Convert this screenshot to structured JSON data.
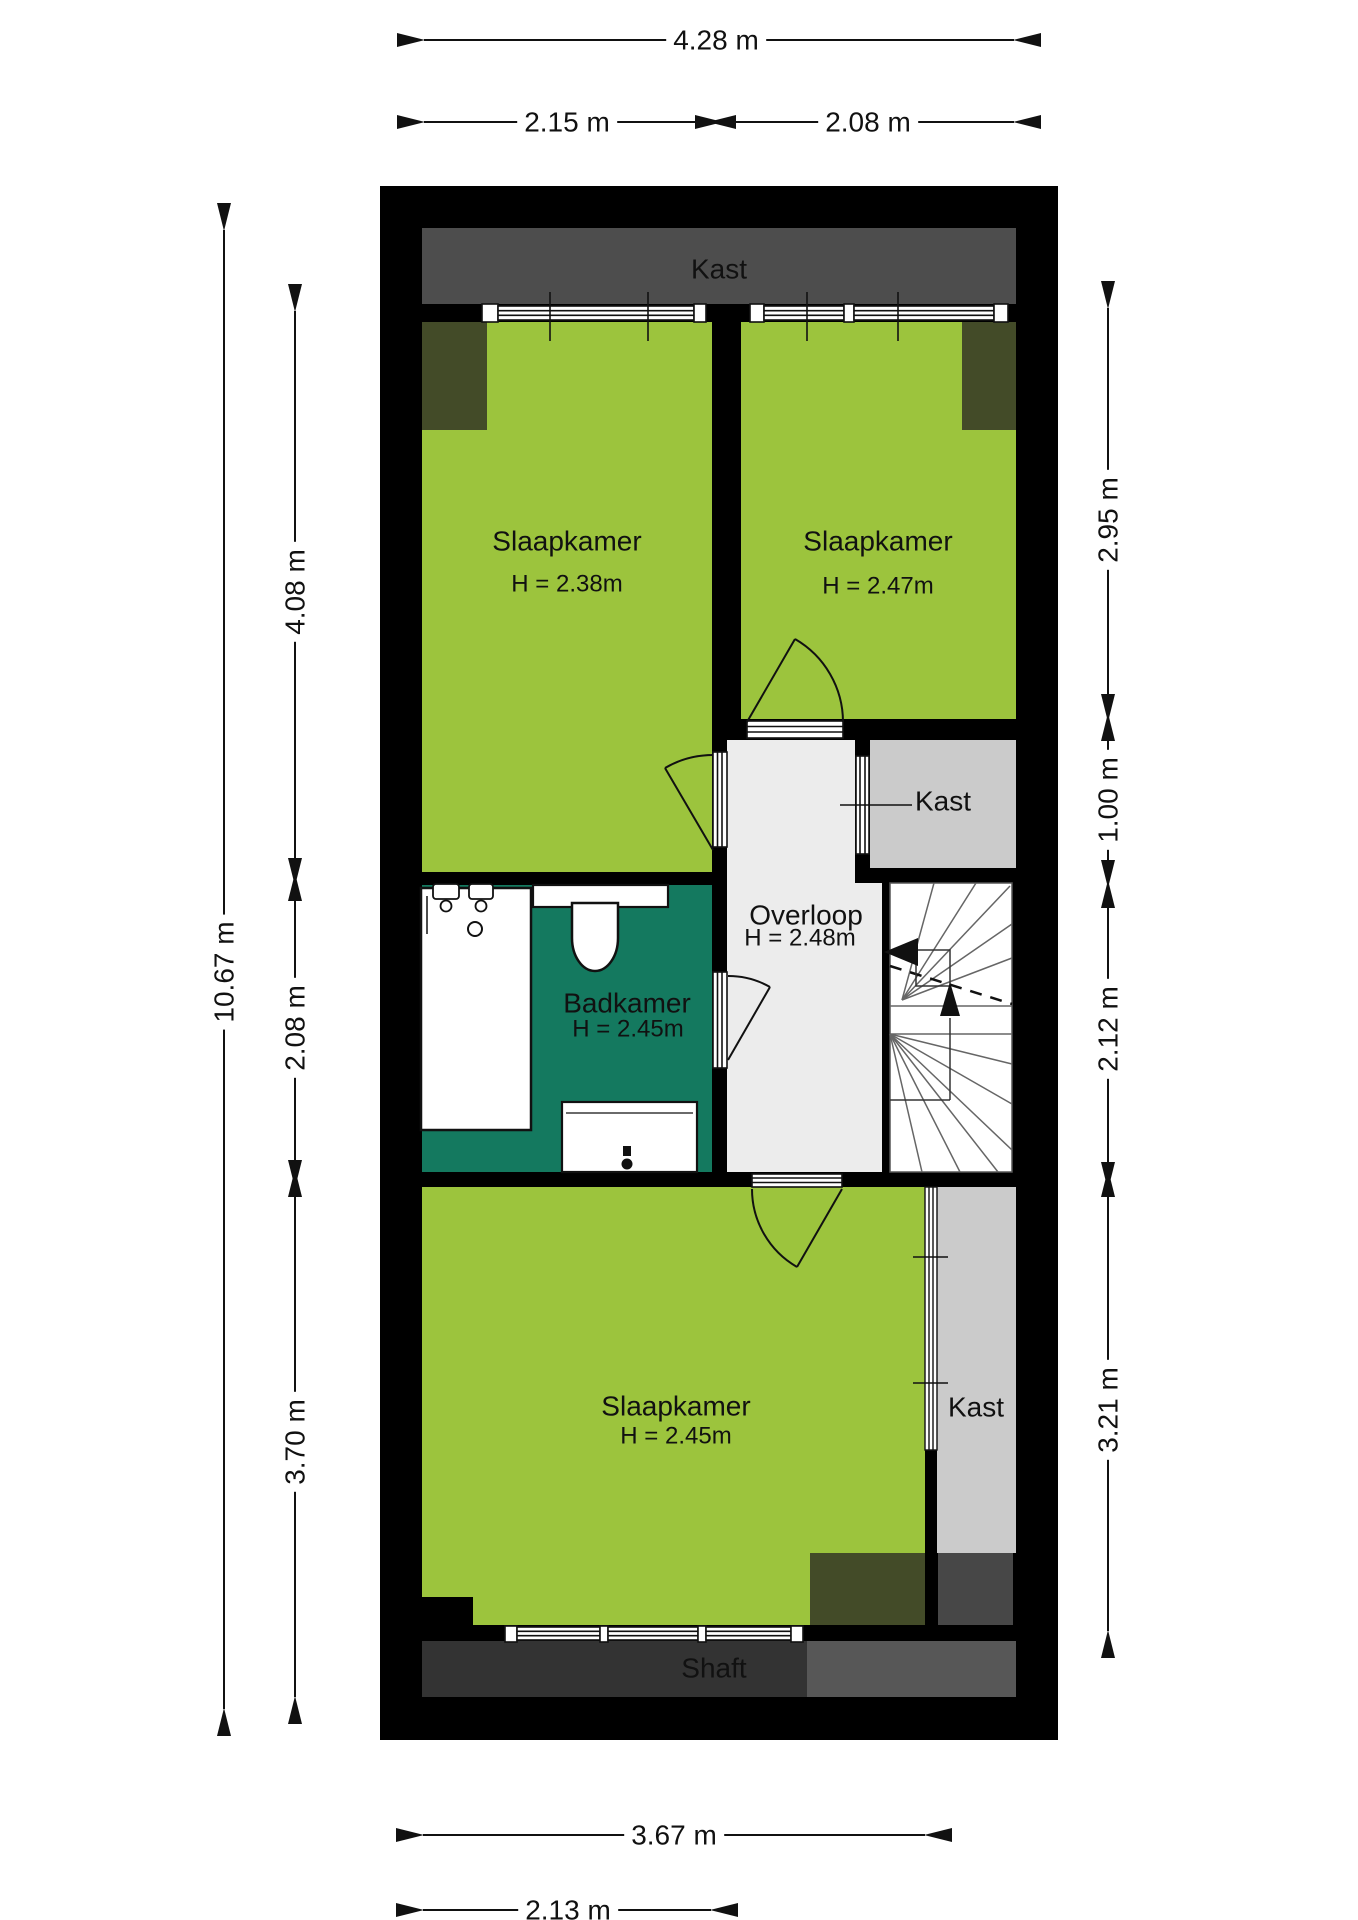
{
  "plan": {
    "rooms": {
      "kast_top": {
        "label": "Kast"
      },
      "slaapkamer_1": {
        "label": "Slaapkamer",
        "height": "H = 2.38m"
      },
      "slaapkamer_2": {
        "label": "Slaapkamer",
        "height": "H = 2.47m"
      },
      "kast_mid": {
        "label": "Kast"
      },
      "overloop": {
        "label": "Overloop",
        "height": "H = 2.48m"
      },
      "badkamer": {
        "label": "Badkamer",
        "height": "H = 2.45m"
      },
      "slaapkamer_3": {
        "label": "Slaapkamer",
        "height": "H = 2.45m"
      },
      "kast_bottom": {
        "label": "Kast"
      },
      "shaft": {
        "label": "Shaft"
      }
    },
    "dimensions": {
      "top": {
        "total": "4.28 m",
        "left": "2.15 m",
        "right": "2.08 m"
      },
      "left": {
        "total": "10.67 m",
        "seg1": "4.08 m",
        "seg2": "2.08 m",
        "seg3": "3.70 m"
      },
      "right": {
        "seg1": "2.95 m",
        "seg2": "1.00 m",
        "seg3": "2.12 m",
        "seg4": "3.21 m"
      },
      "bottom": {
        "seg1": "3.67 m",
        "seg2": "2.13 m"
      }
    },
    "colors": {
      "room_green": "#9cc43d",
      "bathroom_teal": "#14795f",
      "wall_black": "#000000",
      "closet_strip_dark": "#4d4d4d",
      "closet_gray": "#cbcbcb",
      "hall_gray": "#ececec",
      "shaft_dark": "#333333",
      "shaft_light": "#575757",
      "ceiling_olive": "#434b28",
      "dark_square": "#474747"
    }
  }
}
